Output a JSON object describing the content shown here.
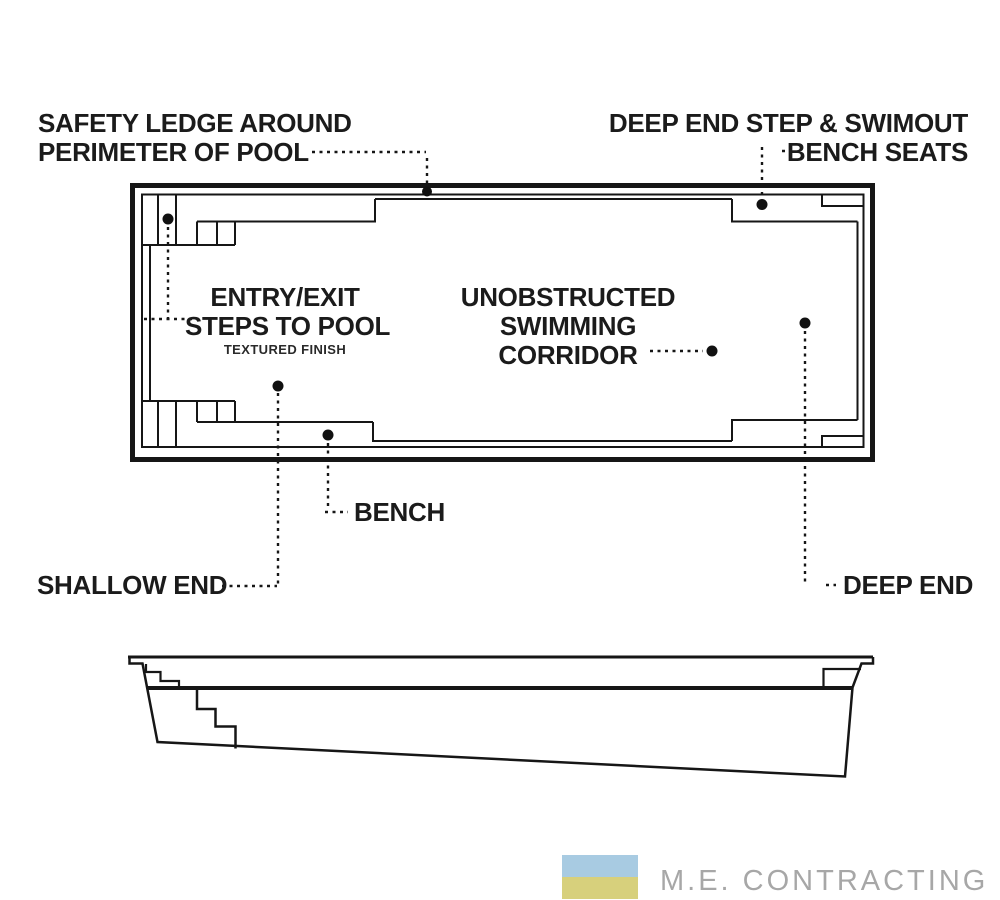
{
  "diagram": {
    "type": "pool-plan-and-section-drawing",
    "ink_color": "#161616",
    "background": "#ffffff"
  },
  "callouts": {
    "safety_ledge": {
      "lines": [
        "SAFETY LEDGE AROUND",
        "PERIMETER OF POOL"
      ]
    },
    "deep_end_swimout": {
      "lines": [
        "DEEP END STEP & SWIMOUT",
        "BENCH SEATS"
      ]
    },
    "entry_exit_steps": {
      "lines": [
        "ENTRY/EXIT",
        "STEPS TO POOL"
      ],
      "note": "TEXTURED FINISH"
    },
    "swimming_corridor": {
      "lines": [
        "UNOBSTRUCTED",
        "SWIMMING",
        "CORRIDOR"
      ]
    },
    "bench": {
      "label": "BENCH"
    },
    "shallow_end": {
      "label": "SHALLOW END"
    },
    "deep_end": {
      "label": "DEEP END"
    }
  },
  "branding": {
    "company": "M.E. CONTRACTING",
    "text_color": "#a7a7a7",
    "logo_colors": {
      "top_block": "#a8cbe2",
      "bottom_block": "#d7d07c"
    }
  }
}
